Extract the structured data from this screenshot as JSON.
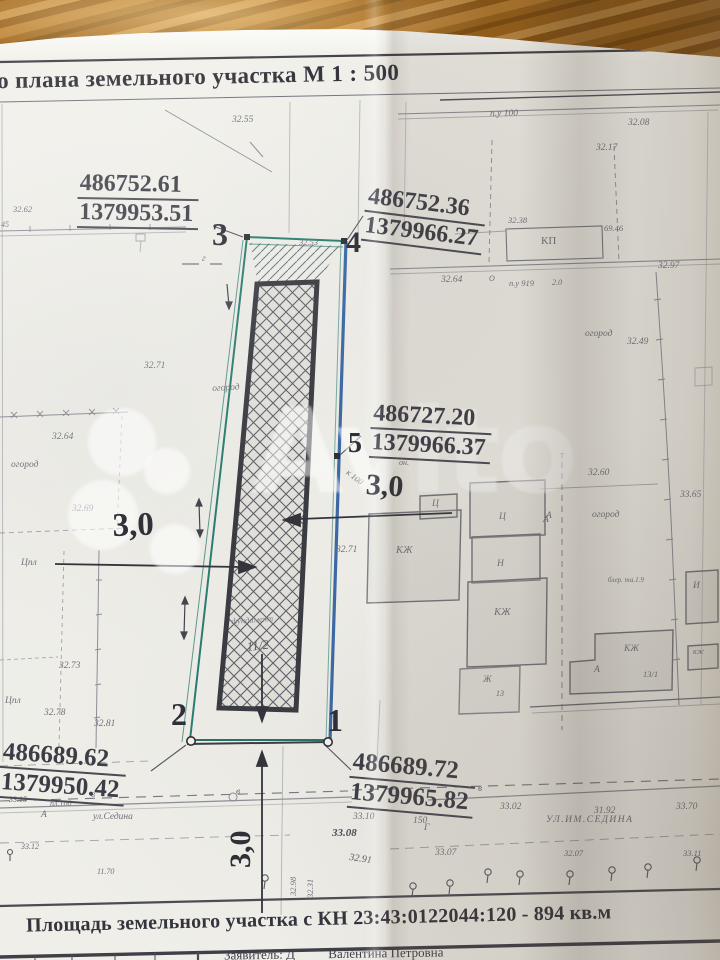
{
  "plan": {
    "title": "о плана земельного участка  М  1 : 500"
  },
  "points": {
    "p3": {
      "label": "3",
      "x": "486752.61",
      "y": "1379953.51"
    },
    "p4": {
      "label": "4",
      "x": "486752.36",
      "y": "1379966.27"
    },
    "p5": {
      "label": "5",
      "x": "486727.20",
      "y": "1379966.37"
    },
    "p2": {
      "label": "2",
      "x": "486689.62",
      "y": "1379950.42"
    },
    "p1": {
      "label": "1",
      "x": "486689.72",
      "y": "1379965.82"
    }
  },
  "dimensions": {
    "left": "3,0",
    "right": "3,0",
    "bottom": "3,0"
  },
  "footer": {
    "area_note": "Площадь земельного участка с КН 23:43:0122044:120 - 894 кв.м",
    "applicant_prefix": "Заявитель: Д",
    "applicant_name": "Валентина Петровна"
  },
  "watermark": {
    "text": "Avito"
  },
  "colors": {
    "parcel_teal": "#2b7c70",
    "parcel_blue": "#2c5d9d",
    "foundation_dark": "#3b3b42",
    "paper": "#f1f0ea",
    "wood": "#a86a1c"
  },
  "plan_labels": [
    {
      "text": "32.55",
      "x": 232,
      "y": 116
    },
    {
      "text": "п.у 100",
      "x": 490,
      "y": 110
    },
    {
      "text": "32.08",
      "x": 628,
      "y": 119
    },
    {
      "text": "32.17",
      "x": 596,
      "y": 144
    },
    {
      "text": "32.38",
      "x": 508,
      "y": 216,
      "size": 8.5
    },
    {
      "text": "КП",
      "x": 541,
      "y": 236,
      "size": 11,
      "italic": false
    },
    {
      "text": "69.46",
      "x": 604,
      "y": 224,
      "size": 8.5
    },
    {
      "text": "32.62",
      "x": 13,
      "y": 205,
      "size": 8.5
    },
    {
      "text": "45",
      "x": 1,
      "y": 221,
      "size": 8
    },
    {
      "text": "32.64",
      "x": 441,
      "y": 276
    },
    {
      "text": "О",
      "x": 489,
      "y": 275,
      "size": 8
    },
    {
      "text": "п.у 919",
      "x": 509,
      "y": 279,
      "size": 8.5
    },
    {
      "text": "2.0",
      "x": 552,
      "y": 279,
      "size": 8
    },
    {
      "text": "32.97",
      "x": 658,
      "y": 262
    },
    {
      "text": "32.49",
      "x": 627,
      "y": 338
    },
    {
      "text": "огород",
      "x": 585,
      "y": 330
    },
    {
      "text": "32.53",
      "x": 299,
      "y": 238,
      "size": 8.5
    },
    {
      "text": "г",
      "x": 202,
      "y": 255
    },
    {
      "text": "32.71",
      "x": 144,
      "y": 362
    },
    {
      "text": "огород",
      "x": 212,
      "y": 385,
      "rot": -3
    },
    {
      "text": "32.64",
      "x": 52,
      "y": 433
    },
    {
      "text": "огород",
      "x": 11,
      "y": 461
    },
    {
      "text": "32.69",
      "x": 72,
      "y": 505
    },
    {
      "text": "он.",
      "x": 399,
      "y": 459,
      "size": 8
    },
    {
      "text": "к 100",
      "x": 350,
      "y": 468,
      "rot": 38,
      "size": 8.5
    },
    {
      "text": "32.71",
      "x": 336,
      "y": 546
    },
    {
      "text": "32.60",
      "x": 588,
      "y": 469
    },
    {
      "text": "Т",
      "x": 560,
      "y": 453,
      "size": 7,
      "italic": false
    },
    {
      "text": "огород",
      "x": 592,
      "y": 511
    },
    {
      "text": "А",
      "x": 546,
      "y": 512
    },
    {
      "text": "33.65",
      "x": 680,
      "y": 491
    },
    {
      "text": "блер. та.1.9",
      "x": 608,
      "y": 577,
      "size": 7
    },
    {
      "text": "КЖ",
      "x": 396,
      "y": 546,
      "size": 10.5
    },
    {
      "text": "Ц",
      "x": 432,
      "y": 500,
      "size": 9.5
    },
    {
      "text": "Ц",
      "x": 499,
      "y": 513,
      "size": 9.5
    },
    {
      "text": "А",
      "x": 543,
      "y": 516
    },
    {
      "text": "Н",
      "x": 497,
      "y": 560,
      "size": 9.5
    },
    {
      "text": "КЖ",
      "x": 494,
      "y": 608,
      "size": 10.5
    },
    {
      "text": "Ж",
      "x": 483,
      "y": 676,
      "size": 9.5
    },
    {
      "text": "13",
      "x": 496,
      "y": 690,
      "size": 8
    },
    {
      "text": "КЖ",
      "x": 624,
      "y": 645,
      "size": 9.5
    },
    {
      "text": "13/1",
      "x": 643,
      "y": 670,
      "size": 8.5
    },
    {
      "text": "А",
      "x": 594,
      "y": 666
    },
    {
      "text": "И",
      "x": 693,
      "y": 582,
      "size": 9.5
    },
    {
      "text": "кж",
      "x": 693,
      "y": 648,
      "size": 8
    },
    {
      "text": "Цпл",
      "x": 21,
      "y": 559
    },
    {
      "text": "32.73",
      "x": 59,
      "y": 662
    },
    {
      "text": "Цпл",
      "x": 5,
      "y": 697
    },
    {
      "text": "32.78",
      "x": 44,
      "y": 709
    },
    {
      "text": "32.81",
      "x": 94,
      "y": 720
    },
    {
      "text": "фундамент",
      "x": 231,
      "y": 617,
      "rot": -4,
      "size": 8.5,
      "color": "#83838c"
    },
    {
      "text": "11/2",
      "x": 246,
      "y": 640,
      "size": 13,
      "rot": -6,
      "color": "#5d5d66"
    },
    {
      "text": "в",
      "x": 91,
      "y": 791
    },
    {
      "text": "в",
      "x": 236,
      "y": 788
    },
    {
      "text": "33.15",
      "x": 9,
      "y": 796,
      "size": 8
    },
    {
      "text": "пл.100",
      "x": 50,
      "y": 800,
      "size": 8
    },
    {
      "text": "А",
      "x": 41,
      "y": 811
    },
    {
      "text": "ул.Седина",
      "x": 93,
      "y": 813,
      "size": 9.5
    },
    {
      "text": "33.10",
      "x": 353,
      "y": 813
    },
    {
      "text": "150",
      "x": 413,
      "y": 817
    },
    {
      "text": "Г",
      "x": 424,
      "y": 824
    },
    {
      "text": "в",
      "x": 478,
      "y": 785
    },
    {
      "text": "33.02",
      "x": 500,
      "y": 803
    },
    {
      "text": "31.92",
      "x": 594,
      "y": 807
    },
    {
      "text": "33.70",
      "x": 676,
      "y": 803
    },
    {
      "text": "УЛ.ИМ.СЕДИНА",
      "x": 546,
      "y": 816,
      "size": 9.5,
      "spacing": 1.5
    },
    {
      "text": "33.08",
      "x": 332,
      "y": 828,
      "size": 11,
      "color": "#4d4d58",
      "bold": true
    },
    {
      "text": "33.07",
      "x": 435,
      "y": 849
    },
    {
      "text": "32.91",
      "x": 350,
      "y": 853,
      "rot": 8,
      "size": 10,
      "color": "#55555f"
    },
    {
      "text": "32.98",
      "x": 289,
      "y": 896,
      "rot": -90,
      "size": 8.5
    },
    {
      "text": "32.31",
      "x": 306,
      "y": 898,
      "rot": -90,
      "size": 8.5
    },
    {
      "text": "33.12",
      "x": 21,
      "y": 843,
      "size": 8
    },
    {
      "text": "11.70",
      "x": 97,
      "y": 868,
      "size": 8
    },
    {
      "text": "32.07",
      "x": 564,
      "y": 849,
      "size": 8.5
    },
    {
      "text": "33.11",
      "x": 683,
      "y": 849,
      "size": 8.5
    }
  ]
}
